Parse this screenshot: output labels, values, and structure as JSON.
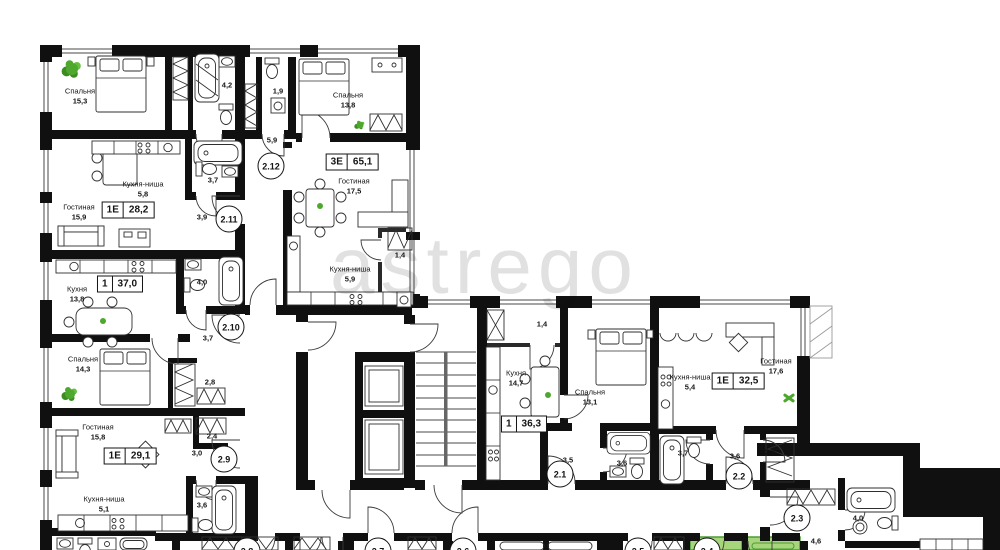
{
  "watermark": "astrego",
  "colors": {
    "wall": "#101010",
    "highlight_fill": "#a6d57c",
    "highlight_border": "#4e9c34",
    "plant_main": "#4ea82e",
    "plant_dark": "#3c8c22",
    "plant_light": "#66bf3f"
  },
  "apartment_badges": [
    {
      "type": "3Е",
      "area": "65,1",
      "x": 352,
      "y": 162
    },
    {
      "type": "1Е",
      "area": "28,2",
      "x": 128,
      "y": 210
    },
    {
      "type": "1",
      "area": "37,0",
      "x": 120,
      "y": 284
    },
    {
      "type": "1Е",
      "area": "29,1",
      "x": 130,
      "y": 456
    },
    {
      "type": "1",
      "area": "36,3",
      "x": 524,
      "y": 424
    },
    {
      "type": "1Е",
      "area": "32,5",
      "x": 738,
      "y": 381
    }
  ],
  "unit_circles": [
    {
      "label": "2.12",
      "x": 271,
      "y": 166
    },
    {
      "label": "2.11",
      "x": 229,
      "y": 219
    },
    {
      "label": "2.10",
      "x": 231,
      "y": 327
    },
    {
      "label": "2.9",
      "x": 224,
      "y": 459
    },
    {
      "label": "2.1",
      "x": 560,
      "y": 474
    },
    {
      "label": "2.2",
      "x": 739,
      "y": 476
    },
    {
      "label": "2.3",
      "x": 797,
      "y": 518
    },
    {
      "label": "2.8",
      "x": 247,
      "y": 551
    },
    {
      "label": "2.7",
      "x": 378,
      "y": 551
    },
    {
      "label": "2.6",
      "x": 463,
      "y": 551
    },
    {
      "label": "2.5",
      "x": 638,
      "y": 551
    },
    {
      "label": "2.4",
      "x": 707,
      "y": 551
    }
  ],
  "room_labels": [
    {
      "name": "Спальня",
      "area": "15,3",
      "x": 80,
      "y": 96
    },
    {
      "name": "Спальня",
      "area": "13,8",
      "x": 348,
      "y": 100
    },
    {
      "name": "Гостиная",
      "area": "17,5",
      "x": 354,
      "y": 186
    },
    {
      "name": "Кухня-ниша",
      "area": "5,9",
      "x": 350,
      "y": 274
    },
    {
      "name": "Кухня-ниша",
      "area": "5,8",
      "x": 143,
      "y": 189
    },
    {
      "name": "Гостиная",
      "area": "15,9",
      "x": 79,
      "y": 212
    },
    {
      "name": "Кухня",
      "area": "13,8",
      "x": 77,
      "y": 294
    },
    {
      "name": "Спальня",
      "area": "14,3",
      "x": 83,
      "y": 364
    },
    {
      "name": "Гостиная",
      "area": "15,8",
      "x": 98,
      "y": 432
    },
    {
      "name": "Кухня-ниша",
      "area": "5,1",
      "x": 104,
      "y": 504
    },
    {
      "name": "Кухня",
      "area": "14,7",
      "x": 516,
      "y": 378
    },
    {
      "name": "Спальня",
      "area": "13,1",
      "x": 590,
      "y": 397
    },
    {
      "name": "Кухня-ниша",
      "area": "5,4",
      "x": 690,
      "y": 382
    },
    {
      "name": "Гостиная",
      "area": "17,6",
      "x": 776,
      "y": 366
    }
  ],
  "area_tags": [
    {
      "value": "4,2",
      "x": 227,
      "y": 85
    },
    {
      "value": "1,9",
      "x": 278,
      "y": 91
    },
    {
      "value": "5,9",
      "x": 272,
      "y": 140
    },
    {
      "value": "3,7",
      "x": 213,
      "y": 180
    },
    {
      "value": "3,9",
      "x": 202,
      "y": 217
    },
    {
      "value": "1,4",
      "x": 400,
      "y": 255
    },
    {
      "value": "4,0",
      "x": 202,
      "y": 282
    },
    {
      "value": "3,7",
      "x": 208,
      "y": 338
    },
    {
      "value": "2,8",
      "x": 210,
      "y": 382
    },
    {
      "value": "2,4",
      "x": 212,
      "y": 436
    },
    {
      "value": "3,0",
      "x": 197,
      "y": 453
    },
    {
      "value": "3,6",
      "x": 202,
      "y": 505
    },
    {
      "value": "1,4",
      "x": 542,
      "y": 324
    },
    {
      "value": "3,5",
      "x": 568,
      "y": 460
    },
    {
      "value": "3,6",
      "x": 622,
      "y": 463
    },
    {
      "value": "3,7",
      "x": 683,
      "y": 453
    },
    {
      "value": "3,6",
      "x": 735,
      "y": 456
    },
    {
      "value": "2,2",
      "x": 770,
      "y": 452
    },
    {
      "value": "4,0",
      "x": 858,
      "y": 518
    },
    {
      "value": "4,6",
      "x": 816,
      "y": 541
    }
  ],
  "plants": [
    {
      "kind": "bush",
      "x": 72,
      "y": 69,
      "s": 22
    },
    {
      "kind": "bush",
      "x": 360,
      "y": 125,
      "s": 13
    },
    {
      "kind": "bush",
      "x": 70,
      "y": 394,
      "s": 19
    },
    {
      "kind": "cross",
      "x": 789,
      "y": 397,
      "s": 13
    },
    {
      "kind": "dot",
      "x": 320,
      "y": 206,
      "s": 6
    },
    {
      "kind": "dot",
      "x": 103,
      "y": 321,
      "s": 6
    },
    {
      "kind": "dot",
      "x": 548,
      "y": 395,
      "s": 6
    }
  ],
  "green_rooms": [
    {
      "x": 690,
      "y": 537,
      "w": 52,
      "h": 13
    },
    {
      "x": 747,
      "y": 537,
      "w": 53,
      "h": 13
    }
  ]
}
